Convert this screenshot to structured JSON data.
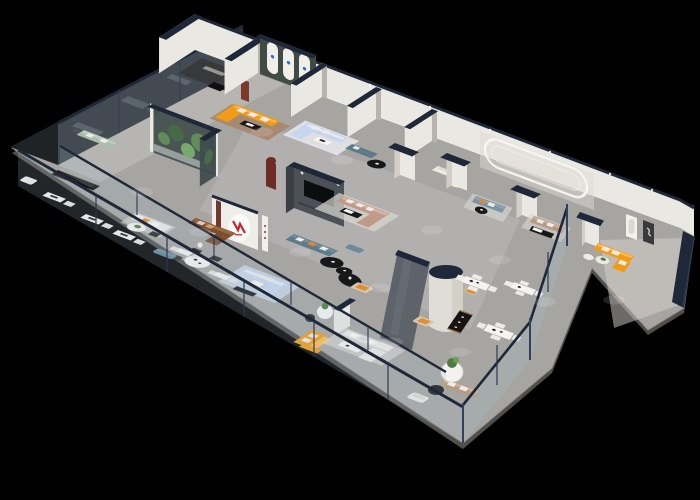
{
  "meta": {
    "type": "3d-isometric-floorplan-cutaway-render",
    "subject": "furniture showroom interior with glass balustrades",
    "background": "black void"
  },
  "palette": {
    "bg": "#000000",
    "floor": "#a6a5a2",
    "floor_light": "#c0bfbc",
    "slab": "#504f4c",
    "wall": "#eae8e2",
    "wall_shade": "#d3cfc7",
    "wall_dark": "#b8b4ac",
    "navy": "#1f2838",
    "navy_light": "#31405c",
    "glass": "#a9becc",
    "dark_room": "#1f2326",
    "dark_furniture": "#41474c",
    "sofa_orange": "#f19b17",
    "sofa_orange_light": "#ffba4e",
    "sofa_blue": "#c8d5ee",
    "sofa_blue_light": "#e3eaf8",
    "sofa_teal": "#5e7b8b",
    "sofa_slate": "#7c93a4",
    "sofa_blush": "#c09a88",
    "sofa_brown": "#7c4c2e",
    "sofa_brown_light": "#9b6740",
    "sofa_sage": "#a9bfab",
    "sofa_tan": "#b79b80",
    "sofa_white": "#edebe7",
    "table_black": "#17181a",
    "table_white": "#f5f4f1",
    "rug_blue": "#cad7e9",
    "rug_gray": "#dbd8d3",
    "wood_floor": "#a5866b",
    "plant": "#4e7d3e",
    "plant_dark": "#2e5226",
    "tv_wall": "#4c5057",
    "panel_gray": "#5a5e66",
    "arch_wall": "#414b46",
    "logo_red": "#c3272b",
    "niche_red": "#6f2b26",
    "marble": "#d7d4ce",
    "gold": "#b98a3c",
    "arch_logo_blue": "#2f6fc1"
  },
  "zones": [
    {
      "name": "showcase-suites",
      "location": "back-left edge",
      "items": [
        "three dark glass display rooms",
        "gray furniture silhouettes"
      ]
    },
    {
      "name": "corner-suite",
      "location": "top corner",
      "items": [
        "white walls with navy caps",
        "dark floor",
        "black lounge chair",
        "red display cabinet"
      ]
    },
    {
      "name": "arch-gallery",
      "location": "top",
      "items": [
        "dark green wall with three white arched panels and small blue logos",
        "orange L-sofa with white pillows",
        "black coffee table",
        "wood floor"
      ]
    },
    {
      "name": "light-blue-lounge",
      "location": "top",
      "items": [
        "light blue L-sofa",
        "white coffee table",
        "maroon arched niche"
      ]
    },
    {
      "name": "mid-vignettes",
      "location": "upper middle",
      "items": [
        "teal loveseat with round black table",
        "white loveseat with round table and plant",
        "white pillars with navy caps",
        "capsule wall molding"
      ]
    },
    {
      "name": "slate-and-tan-lounges",
      "location": "upper right",
      "items": [
        "slate sofa with orange pillow",
        "tan sofa with black-and-white coffee table"
      ]
    },
    {
      "name": "wing-suite",
      "location": "far right",
      "items": [
        "orange L-sofa",
        "round glass table with plant",
        "arched mirror art",
        "dark framed art",
        "navy end wall"
      ]
    },
    {
      "name": "center-lounges",
      "items": [
        "glass terrarium plant box",
        "white oval logo wall with red emblem",
        "brown leather sofa",
        "white round dining table with dark chairs",
        "dark TV feature wall",
        "teal sofa",
        "two round black coffee tables",
        "blush sectional with white pillows",
        "light blue U-sectional on blue rug",
        "smoked glass partition",
        "white cylinder column",
        "cream armchairs with orange cushions",
        "black display console with gold trim"
      ]
    },
    {
      "name": "front-corridor",
      "items": [
        "glass balustrade with navy rail",
        "sage green sofa",
        "black sideboard",
        "white desks with chairs",
        "white sofa set with plant table",
        "teal ottoman"
      ]
    },
    {
      "name": "bottom-suites",
      "items": [
        "orange accent sofa",
        "white sectional on gray rug",
        "white armchair",
        "tan sofa",
        "round white table with plant",
        "black oval table",
        "white dining sets with vases"
      ]
    }
  ],
  "signage": {
    "logo_wall_emblem": "red angular mark, illegible small text",
    "arch_panel_marks": "small blue emblems, illegible"
  }
}
